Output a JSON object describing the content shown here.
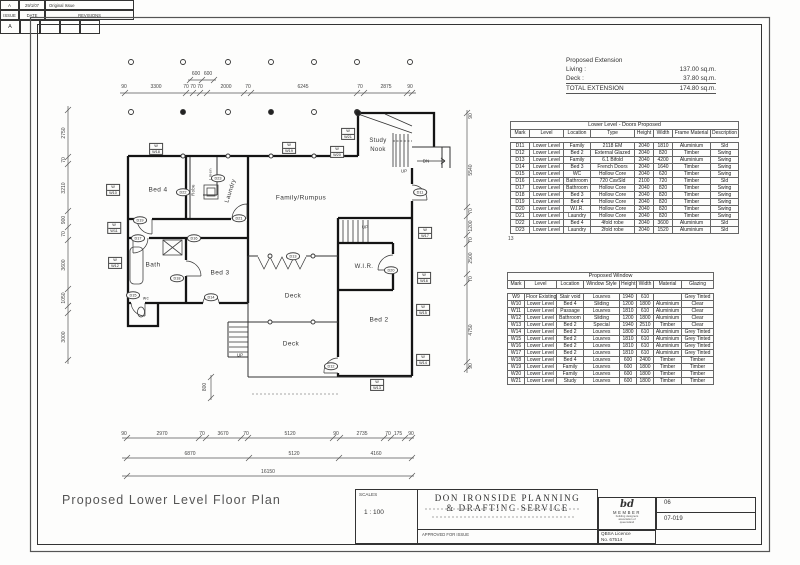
{
  "plan_title": "Proposed Lower Level Floor Plan",
  "note": "13",
  "extension": {
    "title": "Proposed Extension",
    "rows": [
      {
        "label": "Living :",
        "value": "137.00 sq.m."
      },
      {
        "label": "Deck :",
        "value": "37.80 sq.m."
      },
      {
        "label": "TOTAL EXTENSION",
        "value": "174.80 sq.m."
      }
    ]
  },
  "doors_table": {
    "title": "Lower Level - Doors Proposed",
    "headers": [
      "Mark",
      "Level",
      "Location",
      "Type",
      "Height",
      "Width",
      "Frame Material",
      "Description"
    ],
    "rows": [
      [
        "D11",
        "Lower Level",
        "Family",
        "2118 EM",
        "2040",
        "1810",
        "Aluminium",
        "Sld"
      ],
      [
        "D12",
        "Lower Level",
        "Bed 2",
        "External Glazed",
        "2040",
        "820",
        "Timber",
        "Swing"
      ],
      [
        "D13",
        "Lower Level",
        "Family",
        "6.1 Bifold",
        "2040",
        "4200",
        "Aluminium",
        "Swing"
      ],
      [
        "D14",
        "Lower Level",
        "Bed 3",
        "French Doors",
        "2040",
        "1640",
        "Timber",
        "Swing"
      ],
      [
        "D15",
        "Lower Level",
        "WC",
        "Hollow Core",
        "2040",
        "620",
        "Timber",
        "Swing"
      ],
      [
        "D16",
        "Lower Level",
        "Bathroom",
        "720 CavSld",
        "2100",
        "720",
        "Timber",
        "Sld"
      ],
      [
        "D17",
        "Lower Level",
        "Bathroom",
        "Hollow Core",
        "2040",
        "820",
        "Timber",
        "Swing"
      ],
      [
        "D18",
        "Lower Level",
        "Bed 3",
        "Hollow Core",
        "2040",
        "820",
        "Timber",
        "Swing"
      ],
      [
        "D19",
        "Lower Level",
        "Bed 4",
        "Hollow Core",
        "2040",
        "820",
        "Timber",
        "Swing"
      ],
      [
        "D20",
        "Lower Level",
        "W.I.R.",
        "Hollow Core",
        "2040",
        "820",
        "Timber",
        "Swing"
      ],
      [
        "D21",
        "Lower Level",
        "Laundry",
        "Hollow Core",
        "2040",
        "820",
        "Timber",
        "Swing"
      ],
      [
        "D22",
        "Lower Level",
        "Bed 4",
        "4fold robe",
        "2040",
        "3600",
        "Aluminium",
        "Sld"
      ],
      [
        "D23",
        "Lower Level",
        "Laundry",
        "2fold robe",
        "2040",
        "1520",
        "Aluminium",
        "Sld"
      ]
    ]
  },
  "windows_table": {
    "title": "Proposed Window",
    "headers": [
      "Mark",
      "Level",
      "Location",
      "Window Style",
      "Height",
      "Width",
      "Material",
      "Glazing"
    ],
    "rows": [
      [
        "W9",
        "Floor Existing",
        "Stair void",
        "Louvres",
        "1940",
        "610",
        "",
        "Grey Tinted"
      ],
      [
        "W10",
        "Lower Level",
        "Bed 4",
        "Sliding",
        "1200",
        "1800",
        "Aluminium",
        "Clear"
      ],
      [
        "W11",
        "Lower Level",
        "Passage",
        "Louvres",
        "1810",
        "610",
        "Aluminium",
        "Clear"
      ],
      [
        "W12",
        "Lower Level",
        "Bathroom",
        "Sliding",
        "1200",
        "1800",
        "Aluminium",
        "Clear"
      ],
      [
        "W13",
        "Lower Level",
        "Bed 2",
        "Special",
        "1940",
        "2510",
        "Timber",
        "Clear"
      ],
      [
        "W14",
        "Lower Level",
        "Bed 2",
        "Louvres",
        "1800",
        "610",
        "Aluminium",
        "Grey Tinted"
      ],
      [
        "W15",
        "Lower Level",
        "Bed 2",
        "Louvres",
        "1810",
        "610",
        "Aluminium",
        "Grey Tinted"
      ],
      [
        "W16",
        "Lower Level",
        "Bed 2",
        "Louvres",
        "1810",
        "610",
        "Aluminium",
        "Grey Tinted"
      ],
      [
        "W17",
        "Lower Level",
        "Bed 2",
        "Louvres",
        "1810",
        "610",
        "Aluminium",
        "Grey Tinted"
      ],
      [
        "W18",
        "Lower Level",
        "Bed 4",
        "Louvres",
        "600",
        "2400",
        "Timber",
        "Timber"
      ],
      [
        "W19",
        "Lower Level",
        "Family",
        "Louvres",
        "600",
        "1800",
        "Timber",
        "Timber"
      ],
      [
        "W20",
        "Lower Level",
        "Family",
        "Louvres",
        "600",
        "1800",
        "Timber",
        "Timber"
      ],
      [
        "W21",
        "Lower Level",
        "Study",
        "Louvres",
        "600",
        "1800",
        "Timber",
        "Timber"
      ]
    ]
  },
  "title_block": {
    "scales_label": "SCALES",
    "scale_value": "1 : 100",
    "company_line1": "DON IRONSIDE PLANNING",
    "company_line2": "& DRAFTING SERVICE",
    "approved_label": "APPROVED FOR ISSUE",
    "issue_value": "A",
    "date_value": "29/1/07",
    "revision_value": "Original Issue",
    "issue_label": "ISSUE",
    "date_label": "DATE",
    "revisions_label": "REVISIONS",
    "logo_text": "bd",
    "member_label": "MEMBER",
    "member_sub1": "building designers",
    "member_sub2": "association of",
    "member_sub3": "queensland",
    "qbsa_line1": "QBSA Licence",
    "qbsa_line2": "No. 67514",
    "sheet_number": "06",
    "job_number": "07-019",
    "rev_box_value": "A"
  },
  "plan": {
    "room_labels": [
      {
        "text": "Bed 4",
        "x": 158,
        "y": 190
      },
      {
        "text": "Robe",
        "x": 193,
        "y": 190,
        "rot": -90,
        "fs": 4.2
      },
      {
        "text": "Linen",
        "x": 210,
        "y": 174,
        "rot": -90,
        "fs": 4
      },
      {
        "text": "Laundry",
        "x": 231,
        "y": 191,
        "rot": -72,
        "fs": 6
      },
      {
        "text": "Family/Rumpus",
        "x": 301,
        "y": 198
      },
      {
        "text": "Study",
        "x": 378,
        "y": 141,
        "fs": 6
      },
      {
        "text": "Nook",
        "x": 378,
        "y": 150,
        "fs": 6
      },
      {
        "text": "Bath",
        "x": 153,
        "y": 265
      },
      {
        "text": "Bed 3",
        "x": 220,
        "y": 273
      },
      {
        "text": "wc",
        "x": 146,
        "y": 298,
        "fs": 4.5
      },
      {
        "text": "Deck",
        "x": 293,
        "y": 296
      },
      {
        "text": "Deck",
        "x": 291,
        "y": 344
      },
      {
        "text": "W.I.R.",
        "x": 364,
        "y": 267,
        "fs": 6
      },
      {
        "text": "Bed 2",
        "x": 379,
        "y": 320
      }
    ],
    "stair_labels": [
      {
        "text": "UP",
        "x": 404,
        "y": 171
      },
      {
        "text": "DN",
        "x": 426,
        "y": 161
      },
      {
        "text": "UP",
        "x": 365,
        "y": 227
      },
      {
        "text": "UP",
        "x": 240,
        "y": 355
      }
    ],
    "door_tags": [
      {
        "id": "D11",
        "x": 420,
        "y": 192
      },
      {
        "id": "D12",
        "x": 331,
        "y": 366
      },
      {
        "id": "D13",
        "x": 293,
        "y": 256
      },
      {
        "id": "D14",
        "x": 211,
        "y": 297
      },
      {
        "id": "D15",
        "x": 133,
        "y": 295
      },
      {
        "id": "D16",
        "x": 194,
        "y": 238
      },
      {
        "id": "D17",
        "x": 138,
        "y": 238
      },
      {
        "id": "D18",
        "x": 177,
        "y": 278
      },
      {
        "id": "D19",
        "x": 140,
        "y": 220
      },
      {
        "id": "D20",
        "x": 391,
        "y": 270
      },
      {
        "id": "D21",
        "x": 239,
        "y": 218
      },
      {
        "id": "D22",
        "x": 183,
        "y": 192
      },
      {
        "id": "D23",
        "x": 218,
        "y": 178
      }
    ],
    "window_tags": [
      {
        "id": "W10",
        "x": 113,
        "y": 190
      },
      {
        "id": "W11",
        "x": 114,
        "y": 228
      },
      {
        "id": "W12",
        "x": 115,
        "y": 263
      },
      {
        "id": "W13",
        "x": 377,
        "y": 385
      },
      {
        "id": "W14",
        "x": 423,
        "y": 360
      },
      {
        "id": "W15",
        "x": 423,
        "y": 310
      },
      {
        "id": "W16",
        "x": 424,
        "y": 278
      },
      {
        "id": "W17",
        "x": 425,
        "y": 233
      },
      {
        "id": "W18",
        "x": 156,
        "y": 149
      },
      {
        "id": "W19",
        "x": 289,
        "y": 148
      },
      {
        "id": "W20",
        "x": 337,
        "y": 152
      },
      {
        "id": "W21",
        "x": 348,
        "y": 134
      }
    ],
    "dim_labels": [
      {
        "t": "90",
        "x": 124,
        "y": 87
      },
      {
        "t": "3300",
        "x": 156,
        "y": 87
      },
      {
        "t": "70",
        "x": 186,
        "y": 87
      },
      {
        "t": "70",
        "x": 193,
        "y": 87
      },
      {
        "t": "70",
        "x": 200,
        "y": 87
      },
      {
        "t": "2000",
        "x": 226,
        "y": 87
      },
      {
        "t": "70",
        "x": 248,
        "y": 87
      },
      {
        "t": "6245",
        "x": 303,
        "y": 87
      },
      {
        "t": "70",
        "x": 360,
        "y": 87
      },
      {
        "t": "2875",
        "x": 386,
        "y": 87
      },
      {
        "t": "90",
        "x": 410,
        "y": 87
      },
      {
        "t": "600",
        "x": 196,
        "y": 74
      },
      {
        "t": "600",
        "x": 208,
        "y": 74
      },
      {
        "t": "2750",
        "x": 64,
        "y": 133,
        "r": -90
      },
      {
        "t": "70",
        "x": 64,
        "y": 160,
        "r": -90
      },
      {
        "t": "3210",
        "x": 64,
        "y": 188,
        "r": -90
      },
      {
        "t": "900",
        "x": 64,
        "y": 220,
        "r": -90
      },
      {
        "t": "70",
        "x": 64,
        "y": 234,
        "r": -90
      },
      {
        "t": "3600",
        "x": 64,
        "y": 265,
        "r": -90
      },
      {
        "t": "1050",
        "x": 64,
        "y": 298,
        "r": -90
      },
      {
        "t": "3000",
        "x": 64,
        "y": 337,
        "r": -90
      },
      {
        "t": "90",
        "x": 471,
        "y": 116,
        "r": -90
      },
      {
        "t": "5540",
        "x": 471,
        "y": 170,
        "r": -90
      },
      {
        "t": "70",
        "x": 471,
        "y": 211,
        "r": -90
      },
      {
        "t": "1200",
        "x": 471,
        "y": 226,
        "r": -90
      },
      {
        "t": "70",
        "x": 471,
        "y": 240,
        "r": -90
      },
      {
        "t": "2500",
        "x": 471,
        "y": 258,
        "r": -90
      },
      {
        "t": "70",
        "x": 471,
        "y": 279,
        "r": -90
      },
      {
        "t": "4750",
        "x": 471,
        "y": 330,
        "r": -90
      },
      {
        "t": "90",
        "x": 471,
        "y": 366,
        "r": -90
      },
      {
        "t": "90",
        "x": 124,
        "y": 434
      },
      {
        "t": "2970",
        "x": 162,
        "y": 434
      },
      {
        "t": "70",
        "x": 202,
        "y": 434
      },
      {
        "t": "3670",
        "x": 223,
        "y": 434
      },
      {
        "t": "70",
        "x": 246,
        "y": 434
      },
      {
        "t": "5120",
        "x": 290,
        "y": 434
      },
      {
        "t": "90",
        "x": 336,
        "y": 434
      },
      {
        "t": "2735",
        "x": 362,
        "y": 434
      },
      {
        "t": "70",
        "x": 388,
        "y": 434
      },
      {
        "t": "175",
        "x": 398,
        "y": 434
      },
      {
        "t": "90",
        "x": 411,
        "y": 434
      },
      {
        "t": "6870",
        "x": 190,
        "y": 454
      },
      {
        "t": "5120",
        "x": 294,
        "y": 454
      },
      {
        "t": "4160",
        "x": 376,
        "y": 454
      },
      {
        "t": "16150",
        "x": 268,
        "y": 472
      },
      {
        "t": "800",
        "x": 205,
        "y": 387,
        "r": -90
      }
    ]
  }
}
